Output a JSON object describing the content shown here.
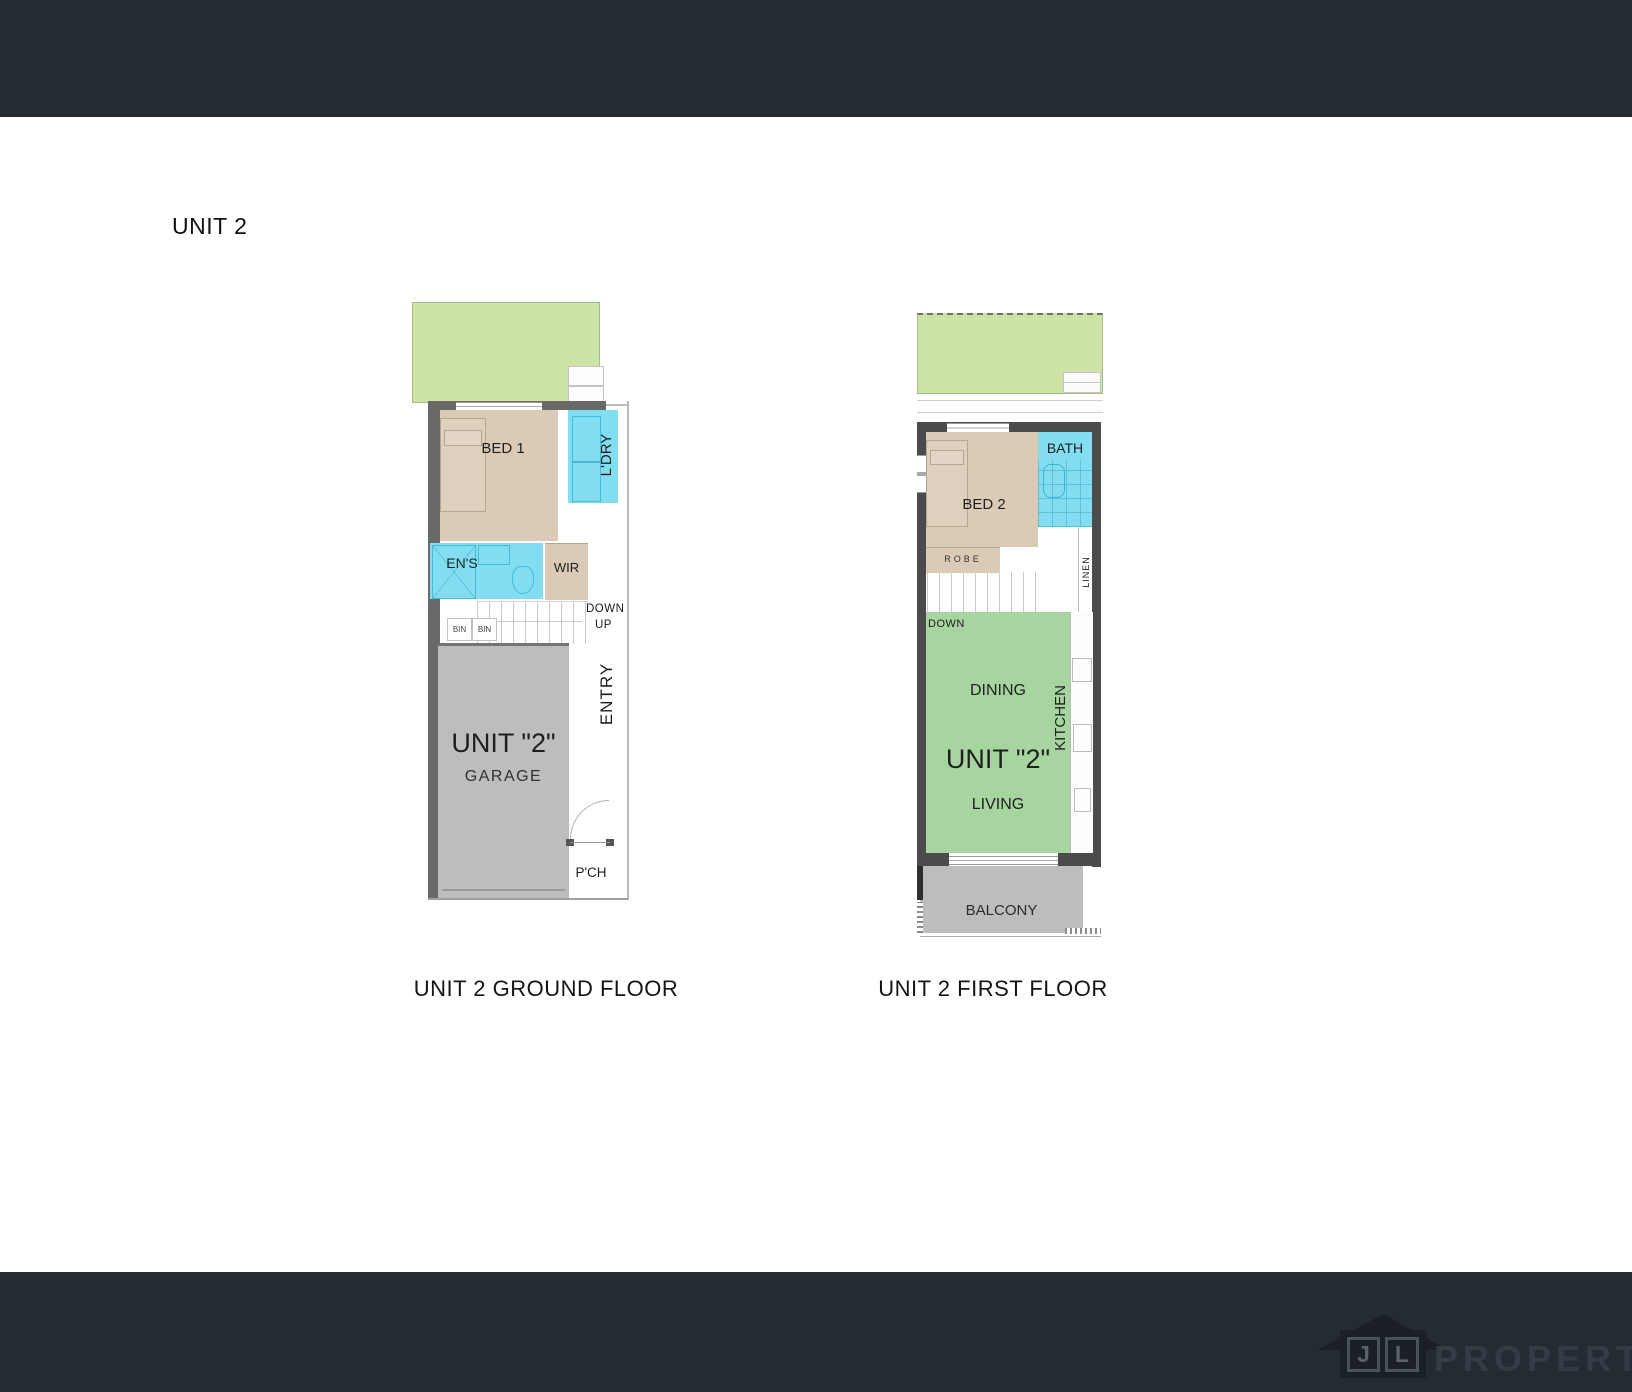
{
  "heading": "UNIT 2",
  "colors": {
    "band": "#242b33",
    "yard_green": "#cde4a6",
    "living_green": "#a7d5a0",
    "room_tan": "#dbcab5",
    "wet_area_cyan": "#82ddf1",
    "hard_surface_gray": "#bdbdbd",
    "wall_gray": "#696969",
    "wall_dark": "#4b4b4b"
  },
  "ground_floor": {
    "caption": "UNIT 2 GROUND FLOOR",
    "rooms": {
      "bed1": "BED 1",
      "ldry": "L'DRY",
      "ens": "EN'S",
      "wir": "WIR",
      "garage_unit": "UNIT \"2\"",
      "garage": "GARAGE",
      "entry": "ENTRY",
      "porch": "P'CH"
    },
    "annotations": {
      "down": "DOWN",
      "up": "UP",
      "bin1": "BIN",
      "bin2": "BIN"
    }
  },
  "first_floor": {
    "caption": "UNIT 2 FIRST FLOOR",
    "rooms": {
      "bed2": "BED 2",
      "bath": "BATH",
      "robe": "ROBE",
      "linen": "LINEN",
      "dining": "DINING",
      "kitchen": "KITCHEN",
      "living_unit": "UNIT \"2\"",
      "living": "LIVING",
      "balcony": "BALCONY"
    },
    "annotations": {
      "down": "DOWN"
    }
  },
  "footer": {
    "logo_j": "J",
    "logo_l": "L",
    "logo_text": "PROPERTY"
  }
}
